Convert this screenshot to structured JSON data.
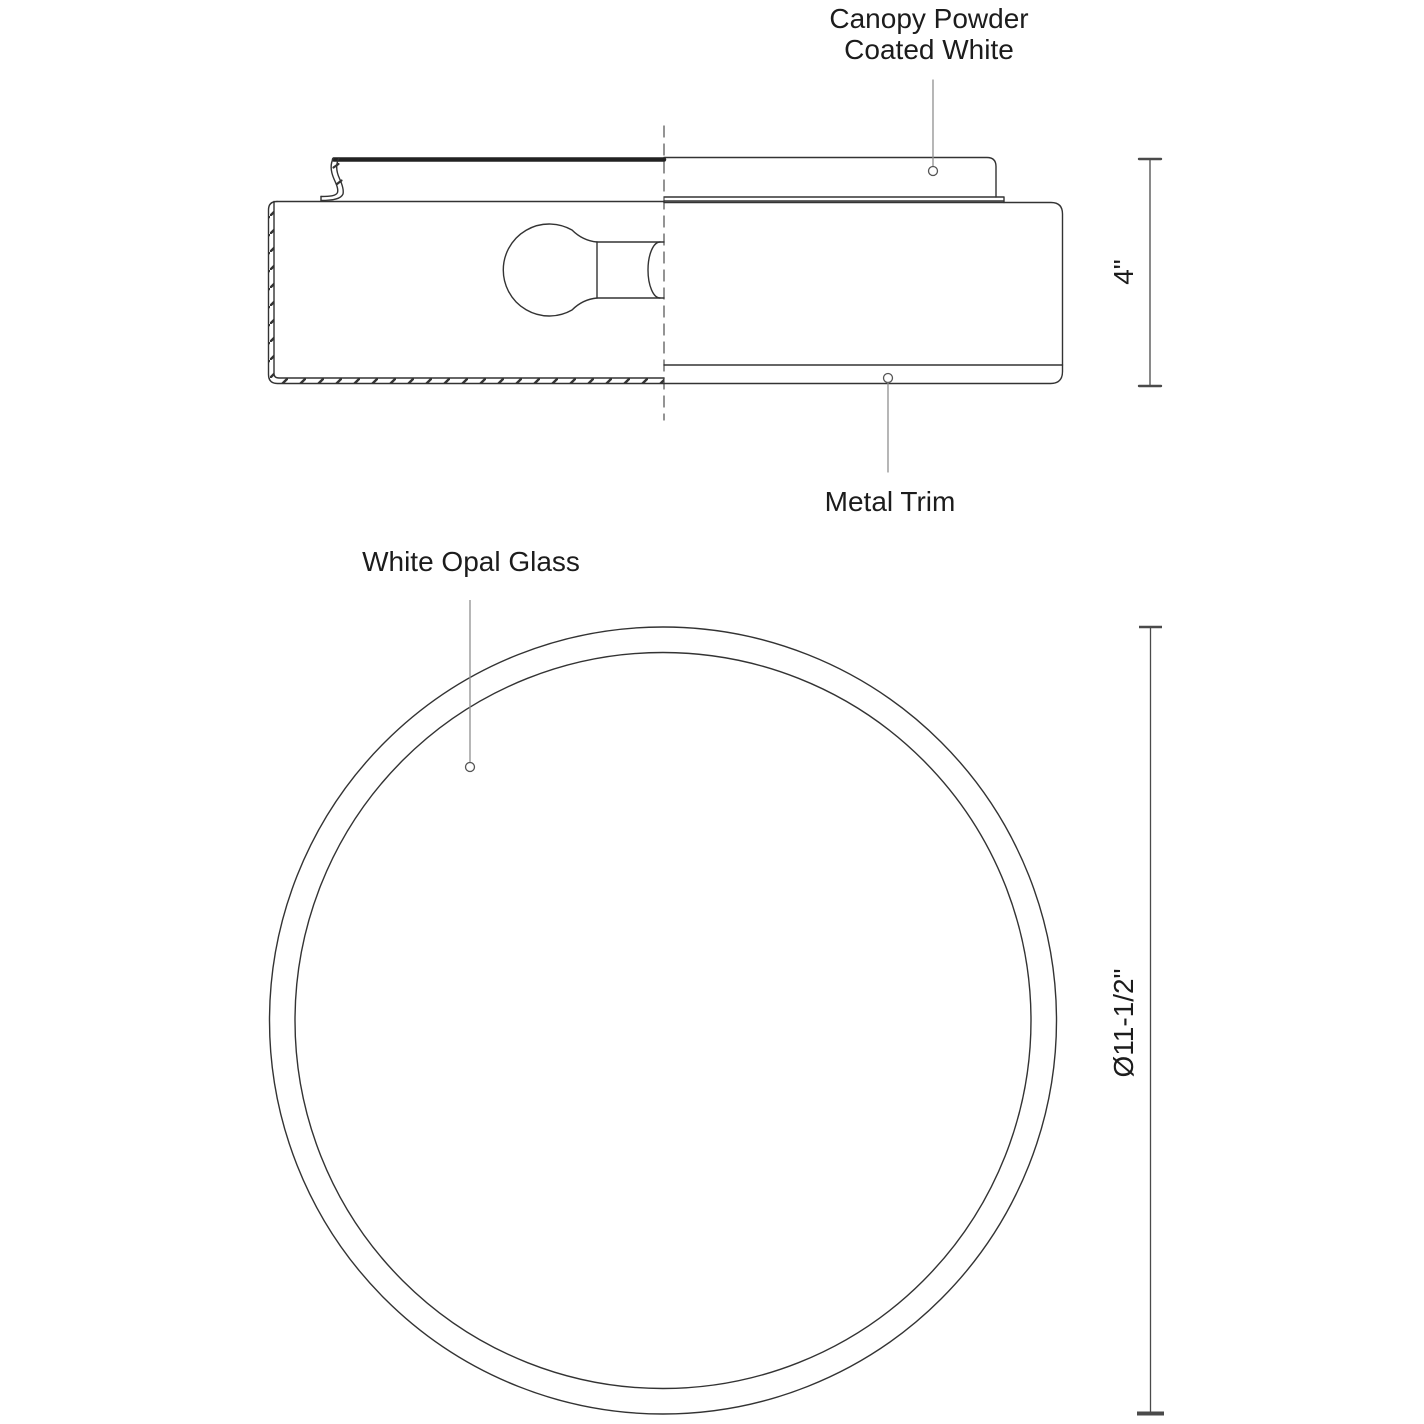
{
  "labels": {
    "canopy": {
      "line1": "Canopy Powder",
      "line2": "Coated White"
    },
    "metal_trim": "Metal Trim",
    "white_opal_glass": "White Opal Glass"
  },
  "dimensions": {
    "height": "4\"",
    "diameter": "Ø11-1/2\""
  },
  "colors": {
    "line": "#333333",
    "leader": "#909090",
    "dimension": "#4a4a4a",
    "background": "#ffffff"
  }
}
